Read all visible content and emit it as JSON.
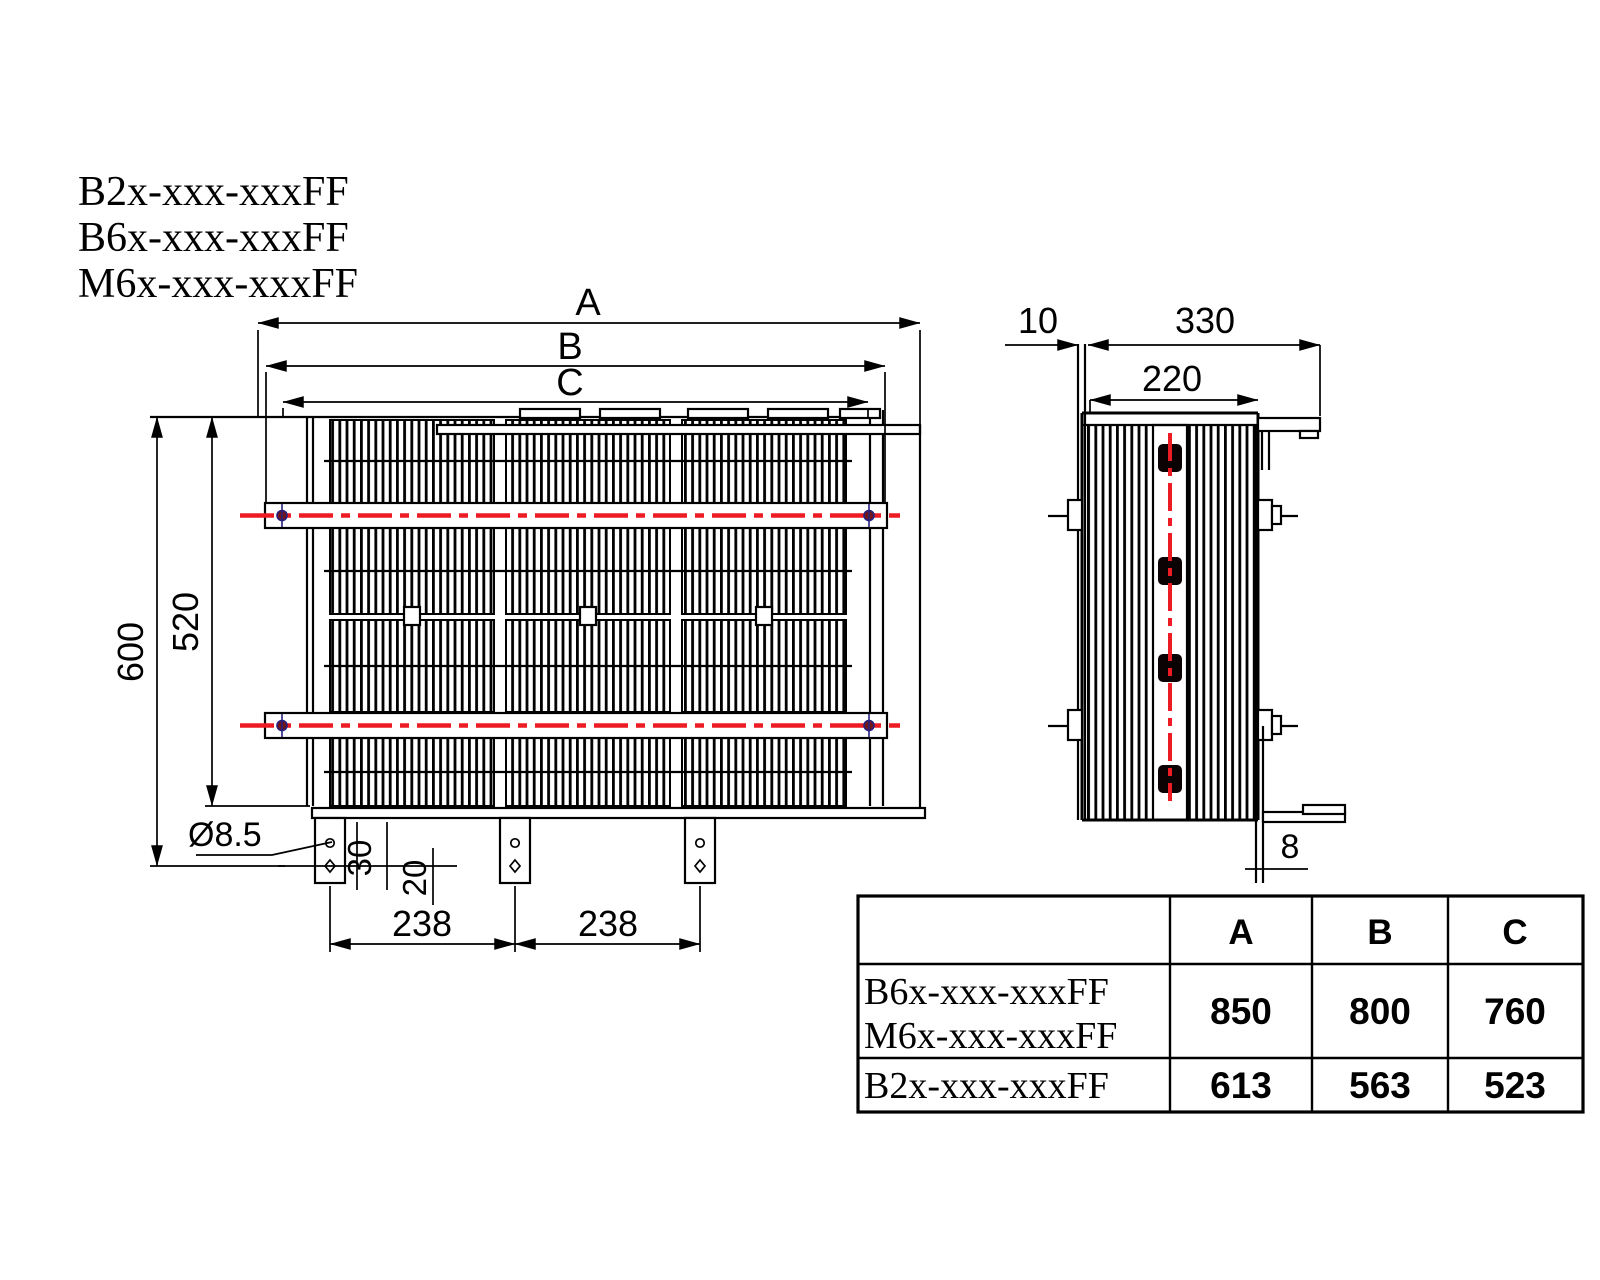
{
  "drawing": {
    "models": [
      "B2x-xxx-xxxFF",
      "B6x-xxx-xxxFF",
      "M6x-xxx-xxxFF"
    ],
    "front_view": {
      "dim_a": "A",
      "dim_b": "B",
      "dim_c": "C",
      "dim_height_outer": "600",
      "dim_height_inner": "520",
      "dim_hole_diameter": "Ø8.5",
      "dim_hole_offset": "30",
      "dim_hole_pitch": "20",
      "dim_foot_spans": [
        "238",
        "238"
      ]
    },
    "side_view": {
      "dim_plate_offset": "10",
      "dim_depth_overall": "330",
      "dim_core_depth": "220",
      "dim_plate_thickness": "8"
    },
    "table": {
      "col_headers": [
        "A",
        "B",
        "C"
      ],
      "rows": [
        {
          "labels": [
            "B6x-xxx-xxxFF",
            "M6x-xxx-xxxFF"
          ],
          "values": [
            "850",
            "800",
            "760"
          ]
        },
        {
          "labels": [
            "B2x-xxx-xxxFF"
          ],
          "values": [
            "613",
            "563",
            "523"
          ]
        }
      ]
    },
    "colors": {
      "line": "#000000",
      "centerline_red": "#ed1c24",
      "marker_blue": "#26207e",
      "terminal_fill": "#0a0203"
    }
  }
}
